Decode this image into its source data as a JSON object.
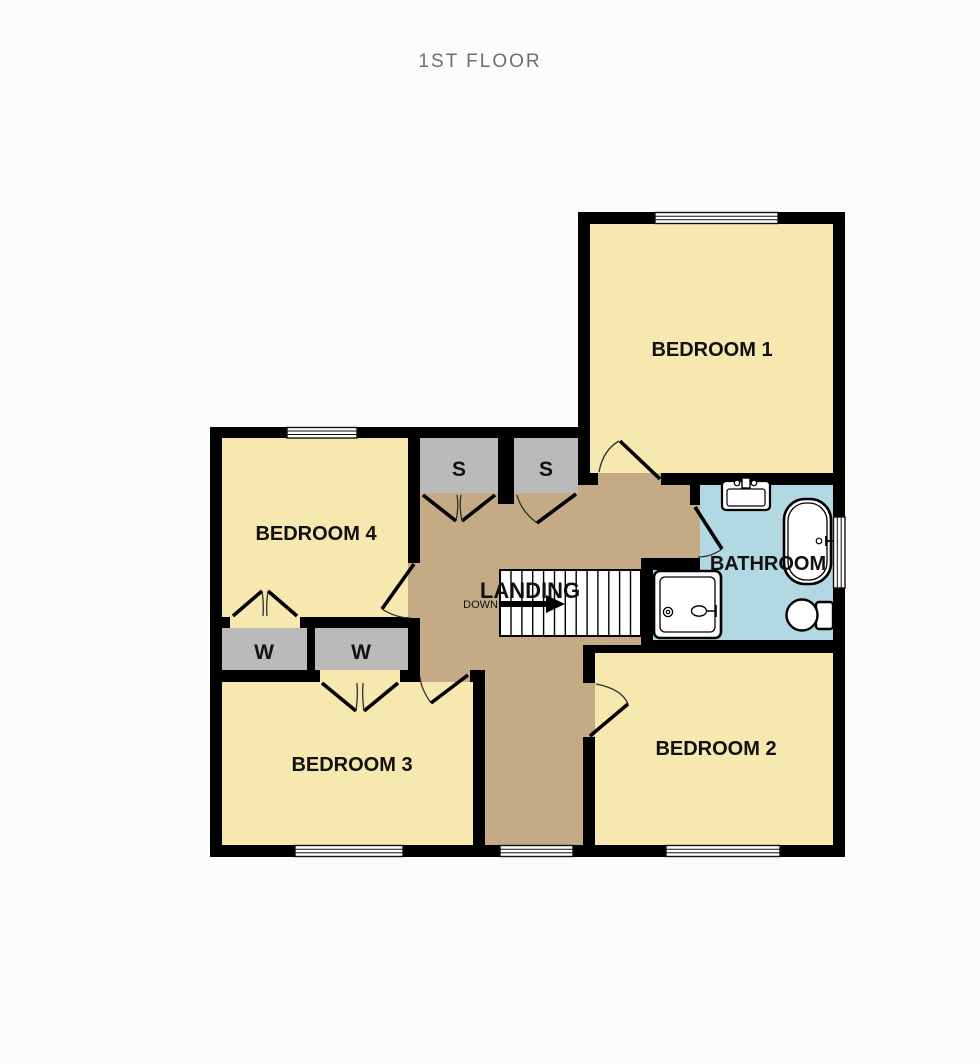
{
  "title": "1ST FLOOR",
  "colors": {
    "background": "#FCFCFA",
    "wall": "#000000",
    "room_fill": "#F7E8AF",
    "landing_fill": "#C5AA86",
    "closet_fill": "#BABABA",
    "bathroom_fill": "#B2D9E3",
    "title_text": "#6E6E6E"
  },
  "rooms": {
    "bedroom1": {
      "label": "BEDROOM 1"
    },
    "bedroom2": {
      "label": "BEDROOM 2"
    },
    "bedroom3": {
      "label": "BEDROOM 3"
    },
    "bedroom4": {
      "label": "BEDROOM 4"
    },
    "bathroom": {
      "label": "BATHROOM"
    },
    "landing": {
      "label": "LANDING"
    },
    "stairs": {
      "direction_label": "DOWN"
    },
    "closets": {
      "storage_label": "S",
      "wardrobe_label": "W"
    }
  },
  "fixtures": {
    "sink": "sink",
    "bathtub": "bathtub",
    "toilet": "toilet",
    "shower": "shower"
  }
}
